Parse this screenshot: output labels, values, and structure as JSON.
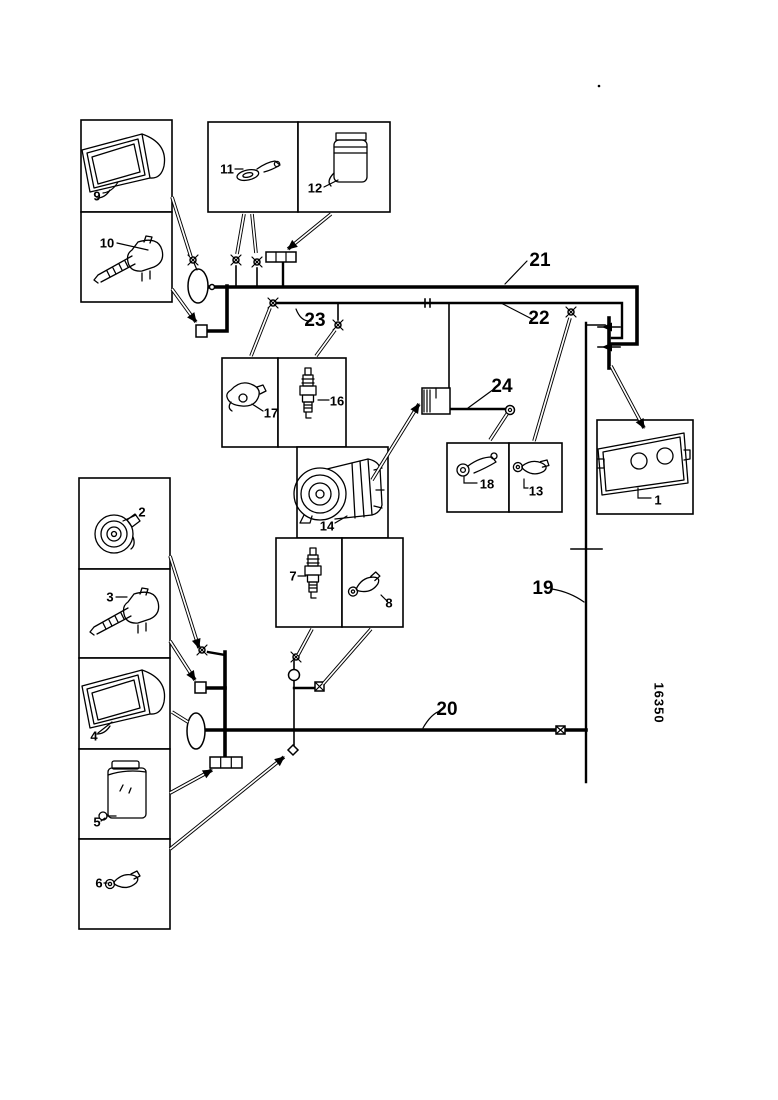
{
  "diagram": {
    "part_number": "16350",
    "labels": {
      "c1": "1",
      "c2": "2",
      "c3": "3",
      "c4": "4",
      "c5": "5",
      "c6": "6",
      "c7": "7",
      "c8": "8",
      "c9": "9",
      "c10": "10",
      "c11": "11",
      "c12": "12",
      "c13": "13",
      "c14": "14",
      "c16": "16",
      "c17": "17",
      "c18": "18",
      "h19": "19",
      "h20": "20",
      "h21": "21",
      "h22": "22",
      "h23": "23",
      "h24": "24"
    }
  }
}
